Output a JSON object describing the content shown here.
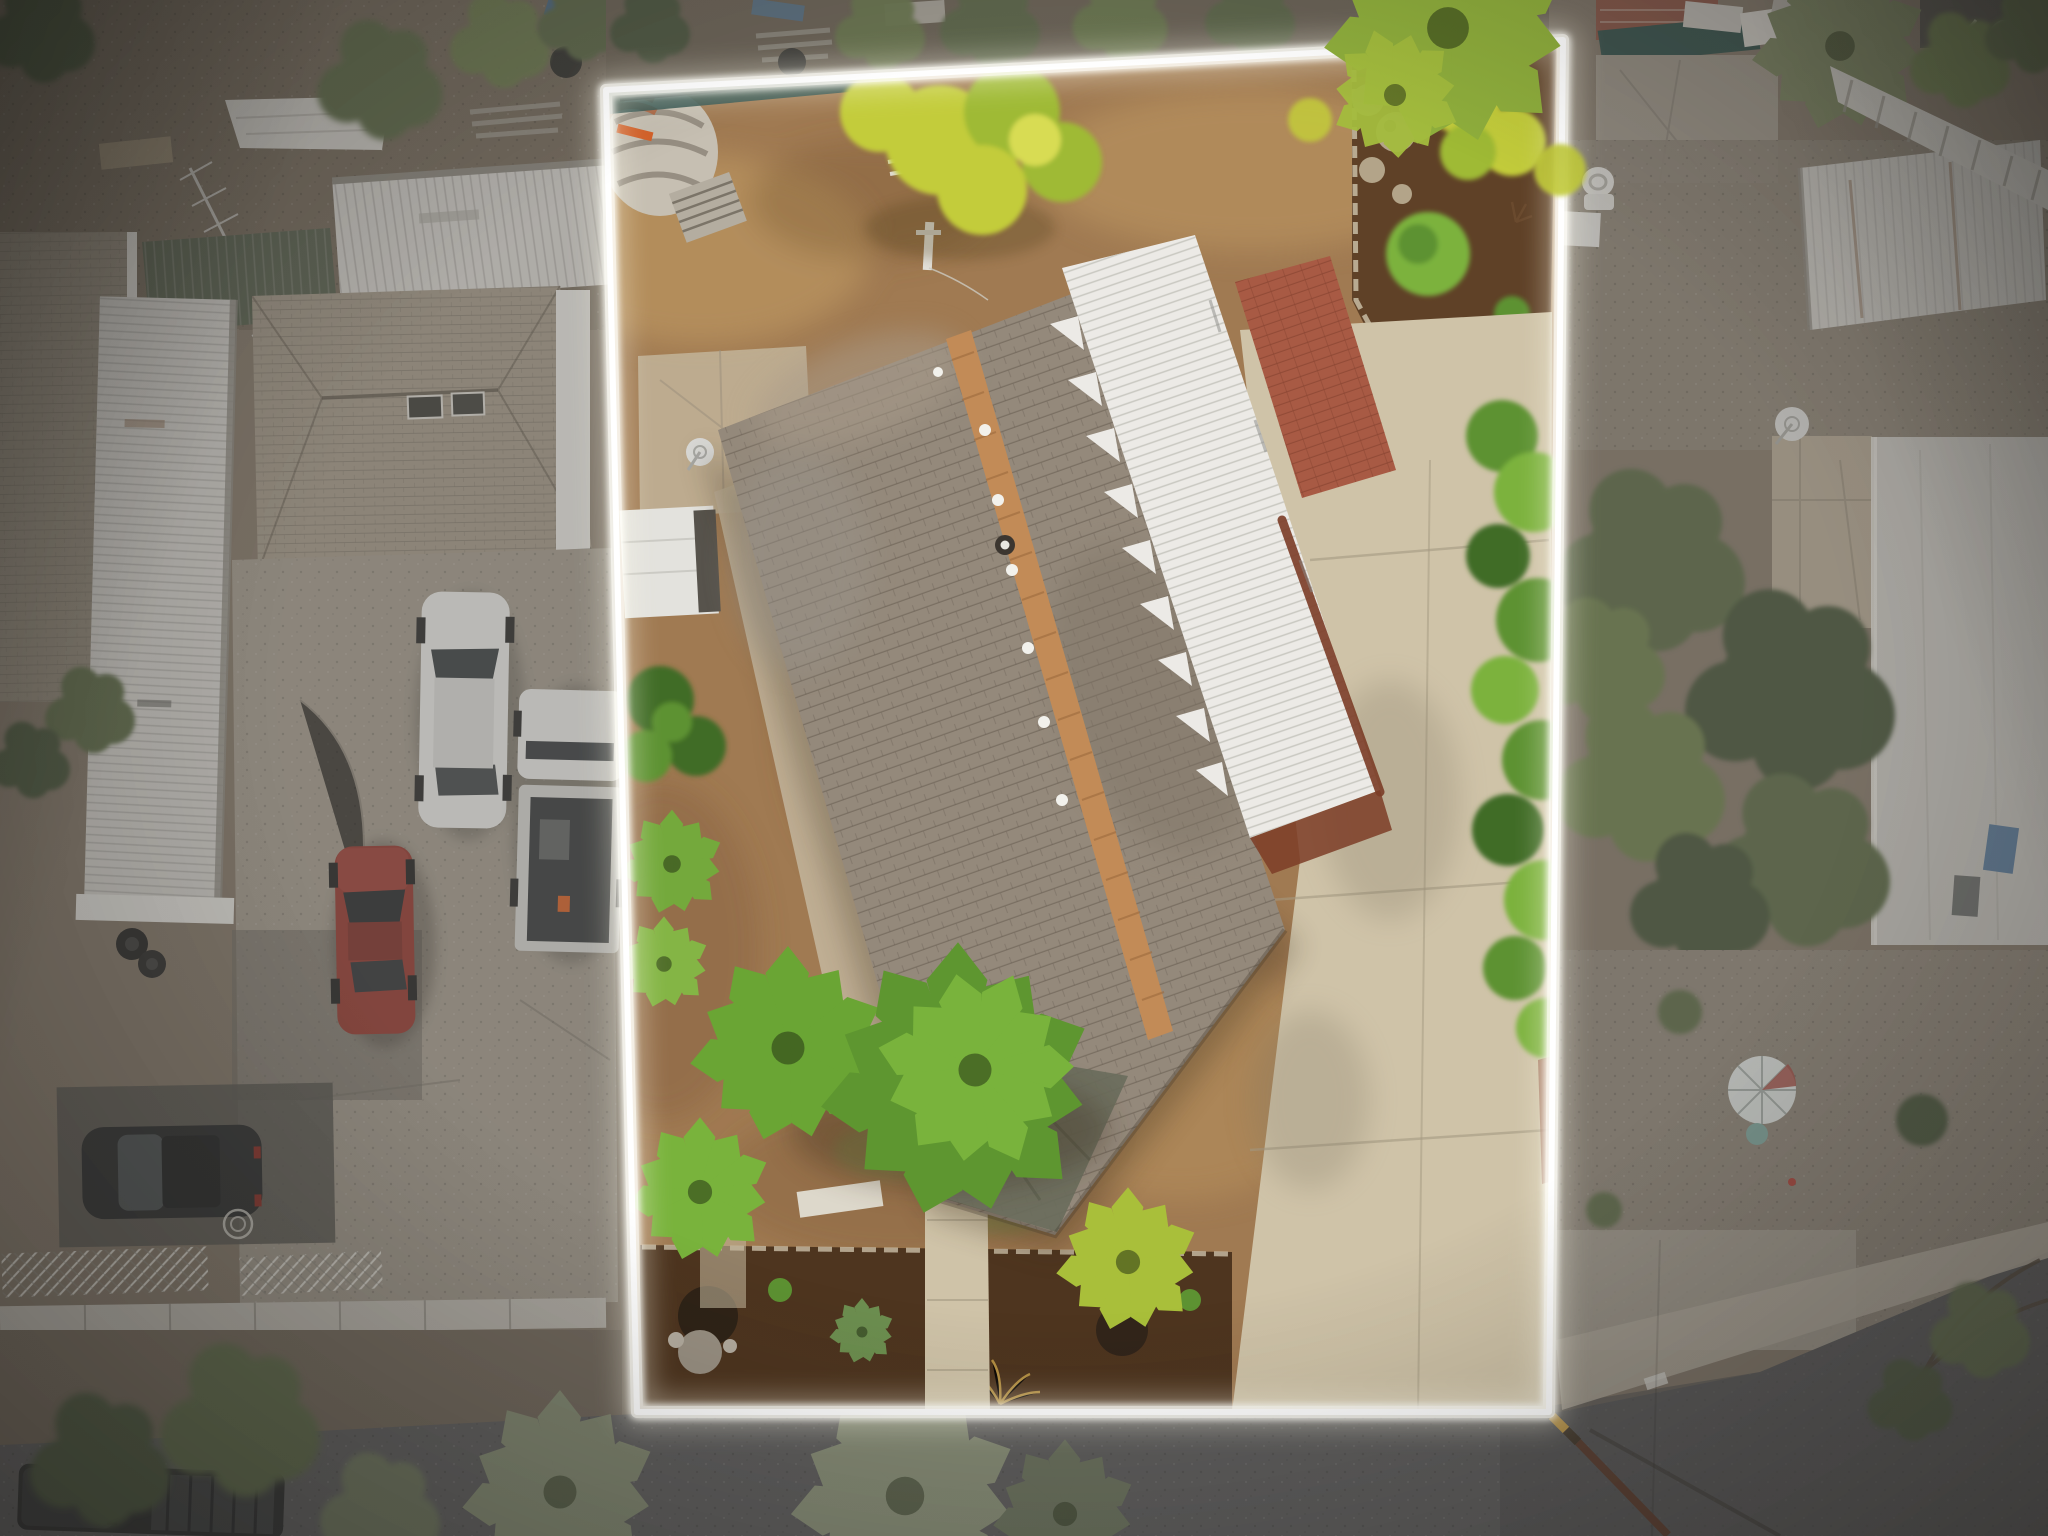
{
  "meta": {
    "type": "aerial-drone-photograph",
    "subject": "Top-down real-estate listing photo of a residential parcel with a glowing white property-boundary outline; subject lot brightly lit, surrounding properties desaturated",
    "width_px": 2048,
    "height_px": 1536
  },
  "boundary": {
    "style": "white glowing outline",
    "corners_px": {
      "top_left": [
        606,
        90
      ],
      "top_right": [
        1563,
        40
      ],
      "bottom_right": [
        1549,
        1412
      ],
      "bottom_left": [
        637,
        1412
      ]
    }
  },
  "palette": {
    "lot_dirt": "#a07a52",
    "lot_dirt_light": "#bb955f",
    "lot_dirt_dark": "#7f5c3a",
    "lot_concrete": "#cfc3a8",
    "lot_concrete2": "#c2b49a",
    "mulch_dark": "#4e351f",
    "mulch_mid": "#5f4127",
    "garden_rock": "#b3a489",
    "green_bright": "#7cb23c",
    "green_mid": "#5d9232",
    "green_dark": "#3f6c25",
    "chartreuse": "#c3cc3a",
    "yellow_green": "#9fba34",
    "shingle_base": "#94897b",
    "shingle_light": "#a99b8a",
    "shingle_dark": "#7e7365",
    "ridge_tan": "#c28b57",
    "white_metal": "#eceae6",
    "rust": "#7c3d27",
    "brick_path": "#a85a44",
    "out_dirt": "#84786a",
    "out_dirt2": "#74695c",
    "out_gravel": "#8d8478",
    "out_concrete": "#a29a8e",
    "out_concrete_light": "#b5ada0",
    "street": "#5e5e60",
    "street_dark": "#4e4e50",
    "neighbor_shingle": "#a29889",
    "neighbor_shingle2": "#938a7c",
    "corrugated_white": "#d6d4d0",
    "green_roof_strip": "#57604f",
    "olive_tree": "#5c6b47",
    "olive_tree_dark": "#46543a",
    "olive_bright": "#6d7f4e",
    "sage_palm": "#8a9478",
    "sage_palm_dark": "#6f7a61",
    "car_white": "#e8e8e6",
    "car_red": "#943a32",
    "car_dark": "#27292b",
    "teal_tarp": "#2e4f4a",
    "umbrella_white": "#dfe4e2",
    "orange": "#d4622a",
    "glow": "#ffffff"
  },
  "scene": {
    "inside_lot": [
      "bare dirt yard",
      "gable-roof house with gray asphalt shingles",
      "exposed tan ridge strip",
      "white corrugated patio roof with torn edge",
      "rust drip edge",
      "roof vents",
      "satellite dish",
      "white shed",
      "concrete pads and walkways",
      "red brick path",
      "mulch garden bed with rocks and chartreuse bushes (top-right)",
      "green hedge along right boundary",
      "palm cluster (bottom-center)",
      "yellow-green acacia tree (top-center)",
      "fan palm (top-right corner)",
      "bottom mulch bed with fire pits, boulder, agave",
      "central concrete walkway",
      "concrete driveway to street",
      "construction mesh fence along top",
      "concrete rubble mound with steps",
      "orange construction planks"
    ],
    "outside_left": [
      "neighbor hip-roof house with shingles and skylights",
      "white corrugated carport",
      "white corrugated shed roof",
      "green corrugated strip roof",
      "far-left shingle roof",
      "white tarp",
      "fallen TV antenna",
      "orange A-frame barricade",
      "white sedan",
      "white pickup truck",
      "red sedan",
      "black sedan",
      "tire stack",
      "white lattice panels",
      "concrete driveway",
      "sidewalk strip",
      "parkway trees",
      "dark pickup truck on street"
    ],
    "outside_right": [
      "graffiti wall",
      "brick-red roof",
      "teal tarp fence",
      "gravel yards",
      "white toilet",
      "white shed roof",
      "beige chimney block",
      "satellite dish",
      "large pale roof",
      "big olive tree",
      "white fence",
      "patio umbrella",
      "trash bins",
      "overhanging street tree",
      "yellow-black utility pole"
    ],
    "street": [
      "asphalt road across bottom",
      "sage fan palms",
      "concrete sidewalk and driveway aprons"
    ]
  }
}
